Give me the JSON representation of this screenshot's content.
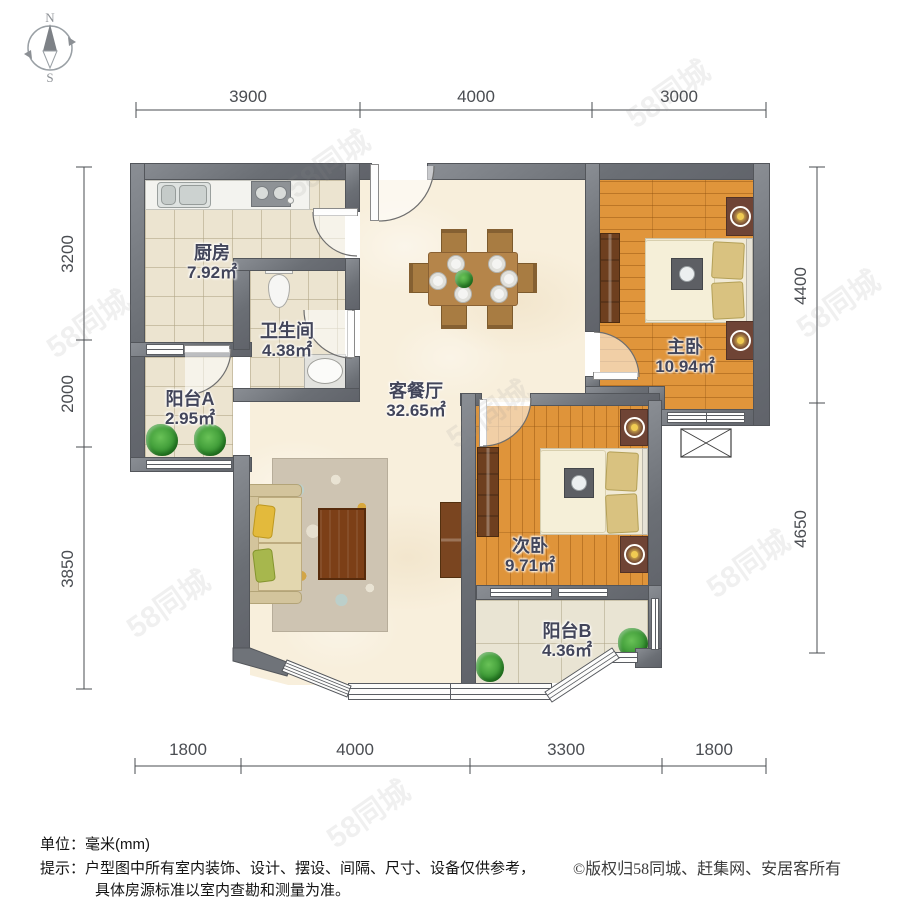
{
  "compass": {
    "north": "N",
    "south": "S"
  },
  "watermark_text": "58同城",
  "rooms": [
    {
      "id": "kitchen",
      "name": "厨房",
      "area": "7.92㎡"
    },
    {
      "id": "bathroom",
      "name": "卫生间",
      "area": "4.38㎡"
    },
    {
      "id": "balcony_a",
      "name": "阳台A",
      "area": "2.95㎡"
    },
    {
      "id": "living_dining",
      "name": "客餐厅",
      "area": "32.65㎡"
    },
    {
      "id": "master_bedroom",
      "name": "主卧",
      "area": "10.94㎡"
    },
    {
      "id": "second_bedroom",
      "name": "次卧",
      "area": "9.71㎡"
    },
    {
      "id": "balcony_b",
      "name": "阳台B",
      "area": "4.36㎡"
    }
  ],
  "dimensions": {
    "top": [
      "3900",
      "4000",
      "3000"
    ],
    "left": [
      "3200",
      "2000",
      "3850"
    ],
    "right": [
      "4400",
      "4650"
    ],
    "bottom": [
      "1800",
      "4000",
      "3300",
      "1800"
    ]
  },
  "footer": {
    "unit_line": "单位：毫米(mm)",
    "tip_line1": "提示：户型图中所有室内装饰、设计、摆设、间隔、尺寸、设备仅供参考，",
    "tip_line2": "具体房源标准以室内查勘和测量为准。",
    "copyright": "©版权归58同城、赶集网、安居客所有"
  },
  "colors": {
    "wall": "#6b6f75",
    "wood_floor": "#e0953b",
    "tile_floor": "#ece4d0",
    "living_floor": "#f8efdc",
    "label_text": "#42455a"
  }
}
